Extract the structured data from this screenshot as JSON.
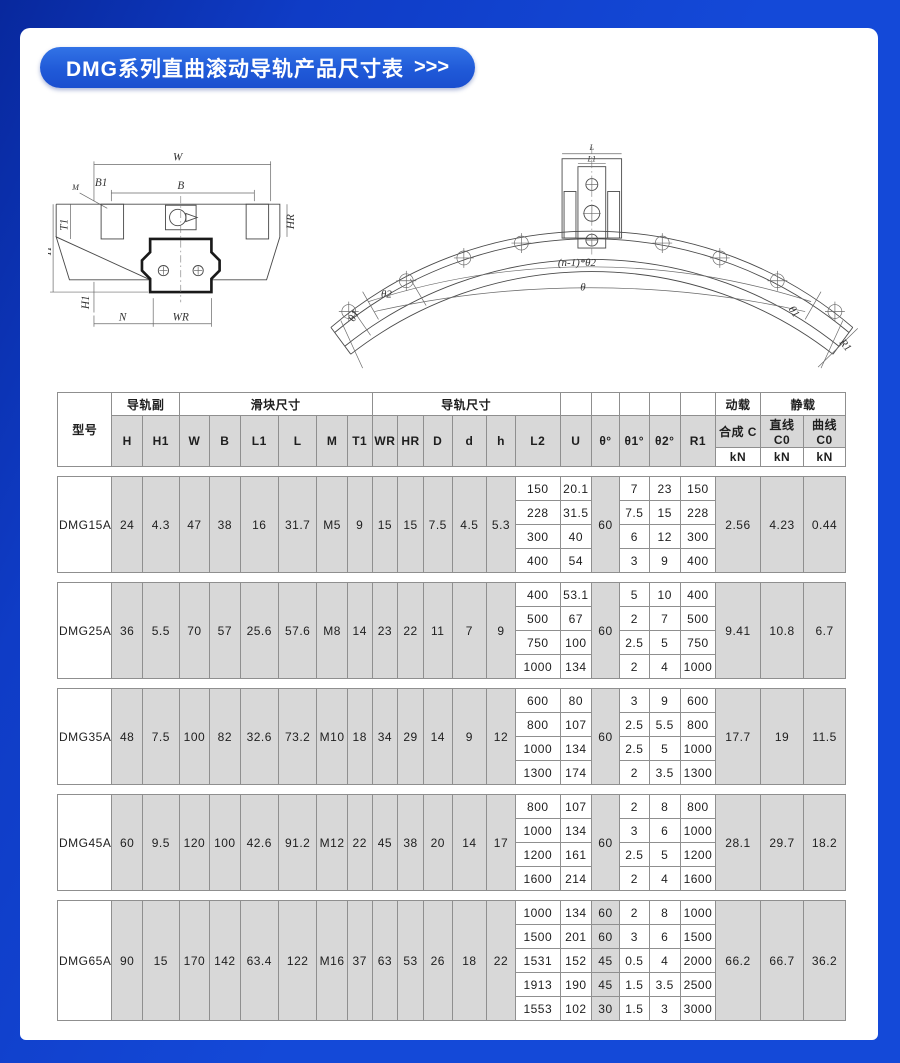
{
  "banner": {
    "title": "DMG系列直曲滚动导轨产品尺寸表",
    "arrows": ">>>"
  },
  "diagram": {
    "left_labels": {
      "W": "W",
      "B": "B",
      "B1": "B1",
      "M": "M",
      "T1": "T1",
      "H": "H",
      "H1": "H1",
      "N": "N",
      "WR": "WR",
      "HR": "HR"
    },
    "right_labels": {
      "L": "L",
      "L1": "L1",
      "theta2": "θ2",
      "theta": "θ",
      "theta1_left": "θ1",
      "theta1_right": "θ1",
      "R1": "R1",
      "n_theta2": "(n-1)*θ2"
    }
  },
  "table": {
    "group_headers": {
      "model": "型号",
      "rail_pair": "导轨副",
      "block_dims": "滑块尺寸",
      "rail_dims": "导轨尺寸",
      "dynamic_load": "动载",
      "static_load": "静载"
    },
    "sub_headers": [
      "H",
      "H1",
      "W",
      "B",
      "L1",
      "L",
      "M",
      "T1",
      "WR",
      "HR",
      "D",
      "d",
      "h",
      "L2",
      "U",
      "θ°",
      "θ1°",
      "θ2°",
      "R1"
    ],
    "load_headers": [
      "合成 C",
      "直线 C0",
      "曲线 C0"
    ],
    "unit_row": [
      "kN",
      "kN",
      "kN"
    ],
    "groups": [
      {
        "model": "DMG15A",
        "dims": [
          "24",
          "4.3",
          "47",
          "38",
          "16",
          "31.7",
          "M5",
          "9",
          "15",
          "15",
          "7.5",
          "4.5",
          "5.3"
        ],
        "theta": "60",
        "subrows": [
          [
            "150",
            "20.1",
            "7",
            "23",
            "150"
          ],
          [
            "228",
            "31.5",
            "7.5",
            "15",
            "228"
          ],
          [
            "300",
            "40",
            "6",
            "12",
            "300"
          ],
          [
            "400",
            "54",
            "3",
            "9",
            "400"
          ]
        ],
        "loads": [
          "2.56",
          "4.23",
          "0.44"
        ]
      },
      {
        "model": "DMG25A",
        "dims": [
          "36",
          "5.5",
          "70",
          "57",
          "25.6",
          "57.6",
          "M8",
          "14",
          "23",
          "22",
          "11",
          "7",
          "9"
        ],
        "theta": "60",
        "subrows": [
          [
            "400",
            "53.1",
            "5",
            "10",
            "400"
          ],
          [
            "500",
            "67",
            "2",
            "7",
            "500"
          ],
          [
            "750",
            "100",
            "2.5",
            "5",
            "750"
          ],
          [
            "1000",
            "134",
            "2",
            "4",
            "1000"
          ]
        ],
        "loads": [
          "9.41",
          "10.8",
          "6.7"
        ]
      },
      {
        "model": "DMG35A",
        "dims": [
          "48",
          "7.5",
          "100",
          "82",
          "32.6",
          "73.2",
          "M10",
          "18",
          "34",
          "29",
          "14",
          "9",
          "12"
        ],
        "theta": "60",
        "subrows": [
          [
            "600",
            "80",
            "3",
            "9",
            "600"
          ],
          [
            "800",
            "107",
            "2.5",
            "5.5",
            "800"
          ],
          [
            "1000",
            "134",
            "2.5",
            "5",
            "1000"
          ],
          [
            "1300",
            "174",
            "2",
            "3.5",
            "1300"
          ]
        ],
        "loads": [
          "17.7",
          "19",
          "11.5"
        ]
      },
      {
        "model": "DMG45A",
        "dims": [
          "60",
          "9.5",
          "120",
          "100",
          "42.6",
          "91.2",
          "M12",
          "22",
          "45",
          "38",
          "20",
          "14",
          "17"
        ],
        "theta": "60",
        "subrows": [
          [
            "800",
            "107",
            "2",
            "8",
            "800"
          ],
          [
            "1000",
            "134",
            "3",
            "6",
            "1000"
          ],
          [
            "1200",
            "161",
            "2.5",
            "5",
            "1200"
          ],
          [
            "1600",
            "214",
            "2",
            "4",
            "1600"
          ]
        ],
        "loads": [
          "28.1",
          "29.7",
          "18.2"
        ]
      },
      {
        "model": "DMG65A",
        "dims": [
          "90",
          "15",
          "170",
          "142",
          "63.4",
          "122",
          "M16",
          "37",
          "63",
          "53",
          "26",
          "18",
          "22"
        ],
        "theta": null,
        "subrows": [
          [
            "1000",
            "134",
            "60",
            "2",
            "8",
            "1000"
          ],
          [
            "1500",
            "201",
            "60",
            "3",
            "6",
            "1500"
          ],
          [
            "1531",
            "152",
            "45",
            "0.5",
            "4",
            "2000"
          ],
          [
            "1913",
            "190",
            "45",
            "1.5",
            "3.5",
            "2500"
          ],
          [
            "1553",
            "102",
            "30",
            "1.5",
            "3",
            "3000"
          ]
        ],
        "loads": [
          "66.2",
          "66.7",
          "36.2"
        ]
      }
    ]
  },
  "colors": {
    "frame_blue": "#1449d8",
    "frame_dark": "#08289d",
    "banner_top": "#3273e6",
    "banner_bottom": "#1a4ecf",
    "cell_gray": "#d8d8d8",
    "grid": "#8f8f8f"
  }
}
